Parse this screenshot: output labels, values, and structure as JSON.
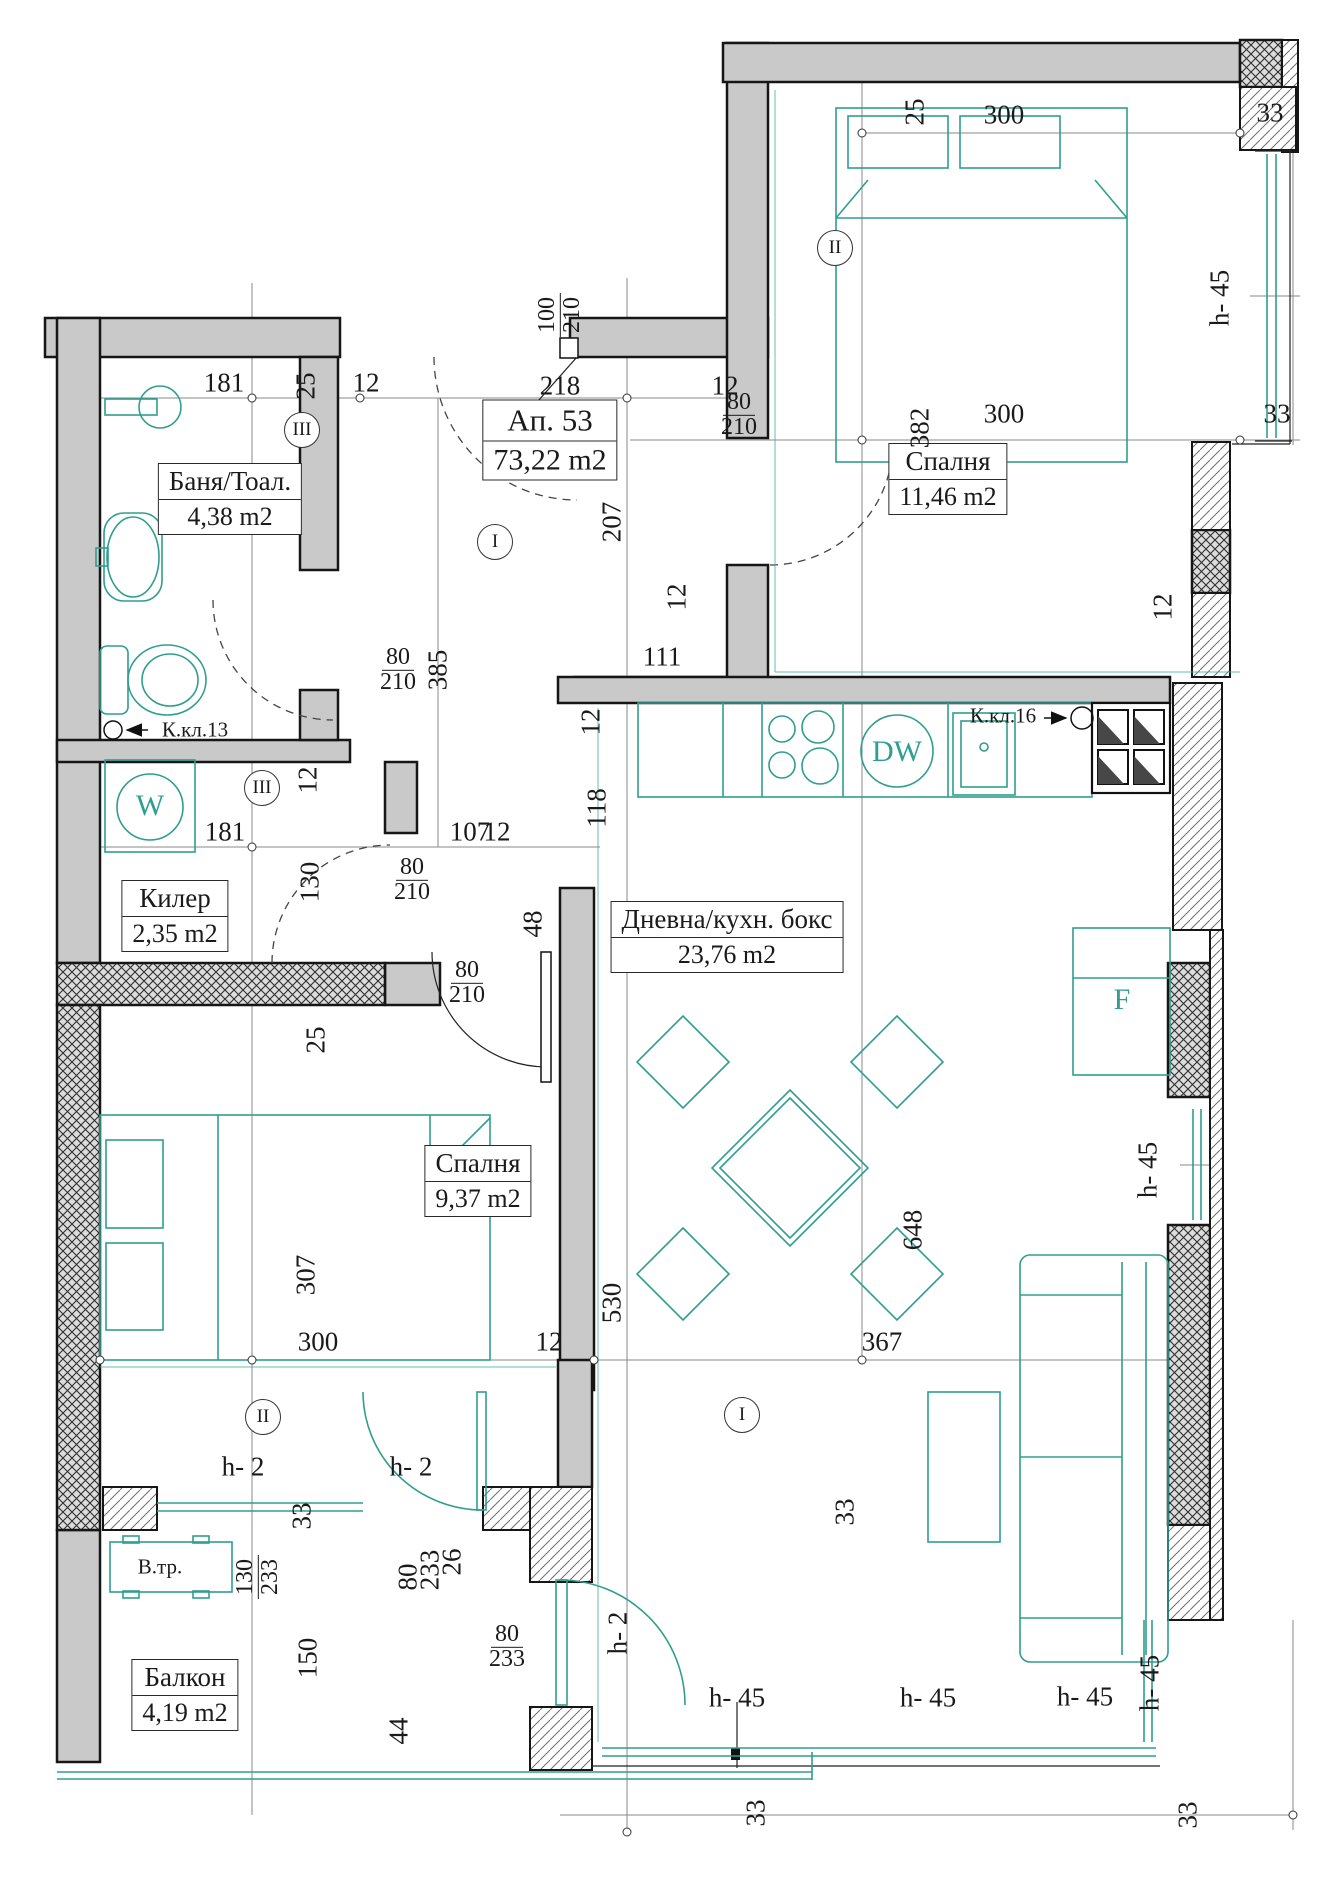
{
  "title": {
    "apartment": "Ап. 53",
    "area": "73,22 m2"
  },
  "rooms": [
    {
      "id": "bath",
      "name": "Баня/Тоал.",
      "area": "4,38 m2"
    },
    {
      "id": "closet",
      "name": "Килер",
      "area": "2,35 m2"
    },
    {
      "id": "bedroom2",
      "name": "Спалня",
      "area": "11,46 m2"
    },
    {
      "id": "living",
      "name": "Дневна/кухн. бокс",
      "area": "23,76 m2"
    },
    {
      "id": "bedroom1",
      "name": "Спалня",
      "area": "9,37 m2"
    },
    {
      "id": "balcony",
      "name": "Балкон",
      "area": "4,19 m2"
    }
  ],
  "annotations": {
    "kkl13": "К.кл.13",
    "kkl16": "К.кл.16",
    "vtr": "В.тр.",
    "washer": "W",
    "dishwasher": "DW",
    "fridge": "F"
  },
  "axis_markers": [
    {
      "label": "I",
      "x": 495,
      "y": 542
    },
    {
      "label": "I",
      "x": 742,
      "y": 1415
    },
    {
      "label": "II",
      "x": 835,
      "y": 248
    },
    {
      "label": "II",
      "x": 263,
      "y": 1417
    },
    {
      "label": "III",
      "x": 302,
      "y": 430
    },
    {
      "label": "III",
      "x": 262,
      "y": 788
    }
  ],
  "dims": [
    {
      "t": "181",
      "x": 224,
      "y": 383
    },
    {
      "t": "25",
      "x": 306,
      "y": 386,
      "r": 90
    },
    {
      "t": "12",
      "x": 366,
      "y": 383
    },
    {
      "t": "218",
      "x": 560,
      "y": 386
    },
    {
      "t": "12",
      "x": 725,
      "y": 386
    },
    {
      "t": "100",
      "b": "210",
      "x": 560,
      "y": 315,
      "r": 90
    },
    {
      "t": "25",
      "x": 915,
      "y": 112,
      "r": 90
    },
    {
      "t": "300",
      "x": 1004,
      "y": 115
    },
    {
      "t": "33",
      "x": 1270,
      "y": 113
    },
    {
      "t": "382",
      "x": 920,
      "y": 428,
      "r": 90
    },
    {
      "t": "300",
      "x": 1004,
      "y": 414
    },
    {
      "t": "33",
      "x": 1277,
      "y": 414
    },
    {
      "t": "80",
      "b": "210",
      "x": 739,
      "y": 415
    },
    {
      "t": "h- 45",
      "x": 1220,
      "y": 298,
      "r": 90
    },
    {
      "t": "207",
      "x": 612,
      "y": 522,
      "r": 90
    },
    {
      "t": "80",
      "b": "210",
      "x": 398,
      "y": 670
    },
    {
      "t": "385",
      "x": 438,
      "y": 670,
      "r": 90
    },
    {
      "t": "111",
      "x": 662,
      "y": 657
    },
    {
      "t": "12",
      "x": 677,
      "y": 597,
      "r": 90
    },
    {
      "t": "12",
      "x": 591,
      "y": 722,
      "r": 90
    },
    {
      "t": "118",
      "x": 597,
      "y": 808,
      "r": 90
    },
    {
      "t": "12",
      "x": 1163,
      "y": 607,
      "r": 90
    },
    {
      "t": "181",
      "x": 225,
      "y": 832
    },
    {
      "t": "107",
      "x": 470,
      "y": 832
    },
    {
      "t": "12",
      "x": 497,
      "y": 832
    },
    {
      "t": "12",
      "x": 308,
      "y": 780,
      "r": 90
    },
    {
      "t": "130",
      "x": 310,
      "y": 882,
      "r": 90
    },
    {
      "t": "80",
      "b": "210",
      "x": 412,
      "y": 880
    },
    {
      "t": "48",
      "x": 533,
      "y": 924,
      "r": 90
    },
    {
      "t": "25",
      "x": 316,
      "y": 1040,
      "r": 90
    },
    {
      "t": "80",
      "b": "210",
      "x": 467,
      "y": 983
    },
    {
      "t": "307",
      "x": 306,
      "y": 1275,
      "r": 90
    },
    {
      "t": "300",
      "x": 318,
      "y": 1342
    },
    {
      "t": "12",
      "x": 549,
      "y": 1342
    },
    {
      "t": "367",
      "x": 882,
      "y": 1342
    },
    {
      "t": "530",
      "x": 612,
      "y": 1303,
      "r": 90
    },
    {
      "t": "648",
      "x": 913,
      "y": 1230,
      "r": 90
    },
    {
      "t": "h- 45",
      "x": 1148,
      "y": 1170,
      "r": 90
    },
    {
      "t": "h- 2",
      "x": 243,
      "y": 1467
    },
    {
      "t": "h- 2",
      "x": 411,
      "y": 1467
    },
    {
      "t": "h- 2",
      "x": 618,
      "y": 1633,
      "r": 90
    },
    {
      "t": "33",
      "x": 302,
      "y": 1516,
      "r": 90
    },
    {
      "t": "33",
      "x": 845,
      "y": 1512,
      "r": 90
    },
    {
      "t": "130",
      "b": "233",
      "x": 258,
      "y": 1577,
      "r": 90
    },
    {
      "t": "80",
      "x": 408,
      "y": 1577,
      "r": 90
    },
    {
      "t": "233",
      "x": 430,
      "y": 1570,
      "r": 90
    },
    {
      "t": "26",
      "x": 452,
      "y": 1562,
      "r": 90
    },
    {
      "t": "80",
      "b": "233",
      "x": 507,
      "y": 1647
    },
    {
      "t": "150",
      "x": 308,
      "y": 1658,
      "r": 90
    },
    {
      "t": "44",
      "x": 399,
      "y": 1731,
      "r": 90
    },
    {
      "t": "h- 45",
      "x": 737,
      "y": 1698
    },
    {
      "t": "h- 45",
      "x": 928,
      "y": 1698
    },
    {
      "t": "h- 45",
      "x": 1085,
      "y": 1697
    },
    {
      "t": "h- 45",
      "x": 1150,
      "y": 1683,
      "r": 90
    },
    {
      "t": "33",
      "x": 756,
      "y": 1813,
      "r": 90
    },
    {
      "t": "33",
      "x": 1188,
      "y": 1815,
      "r": 90
    }
  ],
  "colors": {
    "wall_fill": "#c9c9c9",
    "fixture_teal": "#2f9e8e",
    "line": "#1a1a1a"
  }
}
